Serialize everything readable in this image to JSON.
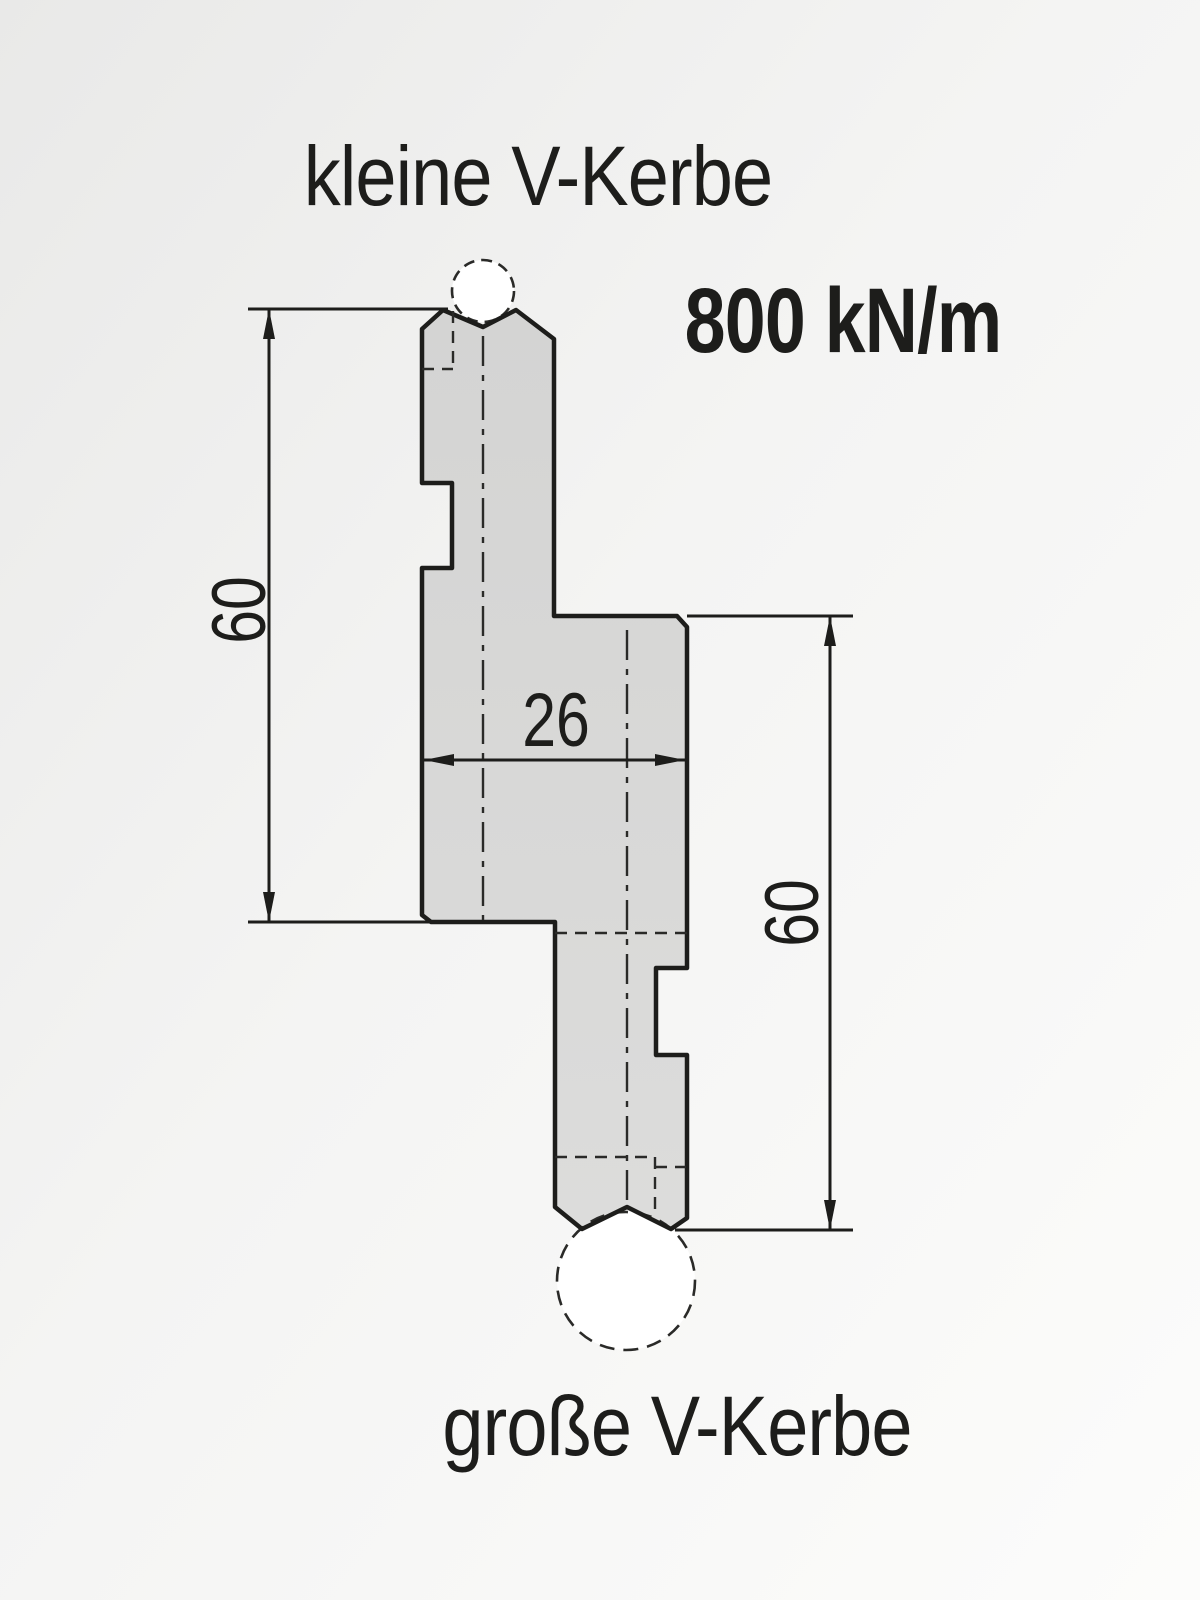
{
  "drawing": {
    "label_top": "kleine V-Kerbe",
    "label_bottom": "große V-Kerbe",
    "force_rating": "800 kN/m",
    "dimensions": {
      "left_height": "60",
      "right_height": "60",
      "body_width": "26"
    }
  },
  "colors": {
    "line": "#1d1d1b",
    "body_fill": "#d8d8d7",
    "background_light": "#fbfbfa",
    "background_dark": "#eaeae9"
  }
}
